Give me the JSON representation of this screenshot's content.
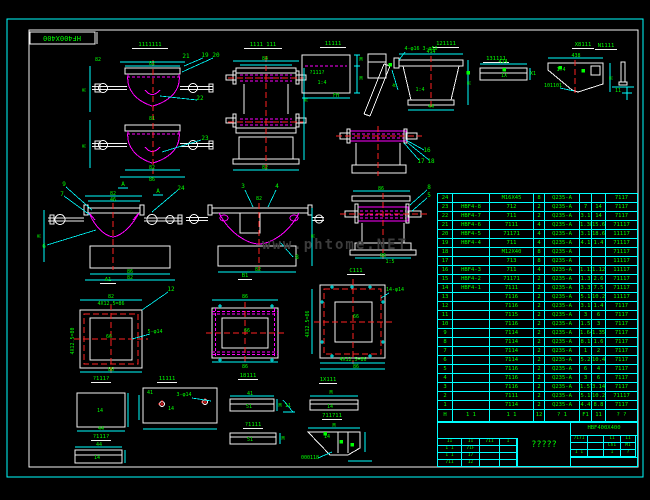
{
  "colors": {
    "background": "#000000",
    "frame_outer": "#00ffff",
    "frame_inner": "#f2f2f2",
    "part_outline": "#ff00ff",
    "dimension": "#00ffff",
    "text": "#00ff00",
    "centerline": "#ff2222",
    "watermark": "#3c3c3c"
  },
  "frame_label": "HF400X400",
  "watermark": "www.phtome.NET",
  "titles": [
    {
      "x": 150,
      "y": 46,
      "w": 36,
      "t": "1111111"
    },
    {
      "x": 263,
      "y": 46,
      "w": 38,
      "t": "1111 111"
    },
    {
      "x": 333,
      "y": 45,
      "w": 26,
      "t": "11111"
    },
    {
      "x": 446,
      "y": 45,
      "w": 26,
      "t": "121111"
    },
    {
      "x": 496,
      "y": 60,
      "w": 26,
      "t": "131111"
    },
    {
      "x": 583,
      "y": 46,
      "w": 22,
      "t": "X8111"
    },
    {
      "x": 606,
      "y": 47,
      "w": 22,
      "t": "N1111"
    },
    {
      "x": 108,
      "y": 281,
      "w": 16,
      "t": "A1"
    },
    {
      "x": 245,
      "y": 277,
      "w": 14,
      "t": "B1"
    },
    {
      "x": 356,
      "y": 272,
      "w": 18,
      "t": "C111"
    },
    {
      "x": 101,
      "y": 380,
      "w": 20,
      "t": "?111?"
    },
    {
      "x": 167,
      "y": 380,
      "w": 20,
      "t": "11111"
    },
    {
      "x": 248,
      "y": 377,
      "w": 20,
      "t": "18111"
    },
    {
      "x": 328,
      "y": 381,
      "w": 18,
      "t": "1X111"
    },
    {
      "x": 101,
      "y": 438,
      "w": 20,
      "t": "?111?"
    },
    {
      "x": 253,
      "y": 426,
      "w": 20,
      "t": "?1111"
    },
    {
      "x": 332,
      "y": 417,
      "w": 20,
      "t": "711711"
    }
  ],
  "dims": [
    {
      "x": 152,
      "y": 65,
      "t": "82"
    },
    {
      "x": 98,
      "y": 61,
      "t": "82"
    },
    {
      "x": 86,
      "y": 90,
      "t": "M",
      "r": -90
    },
    {
      "x": 86,
      "y": 146,
      "t": "M",
      "r": -90
    },
    {
      "x": 152,
      "y": 120,
      "t": "81"
    },
    {
      "x": 152,
      "y": 169,
      "t": "82"
    },
    {
      "x": 152,
      "y": 181,
      "t": "86"
    },
    {
      "x": 265,
      "y": 60,
      "t": "84"
    },
    {
      "x": 308,
      "y": 100,
      "t": "M",
      "r": -90
    },
    {
      "x": 265,
      "y": 169,
      "t": "82"
    },
    {
      "x": 317,
      "y": 74,
      "t": "?111?"
    },
    {
      "x": 322,
      "y": 84,
      "t": "1:4"
    },
    {
      "x": 336,
      "y": 97,
      "t": "FH"
    },
    {
      "x": 361,
      "y": 61,
      "t": "M"
    },
    {
      "x": 361,
      "y": 80,
      "t": "M"
    },
    {
      "x": 396,
      "y": 86,
      "t": "M",
      "r": -70
    },
    {
      "x": 421,
      "y": 50,
      "t": "4-φ16 3-φ50"
    },
    {
      "x": 420,
      "y": 91,
      "t": "1:4"
    },
    {
      "x": 471,
      "y": 83,
      "t": "M",
      "r": -90
    },
    {
      "x": 431,
      "y": 108,
      "t": "44"
    },
    {
      "x": 431,
      "y": 53,
      "t": "414"
    },
    {
      "x": 503,
      "y": 63,
      "t": "414"
    },
    {
      "x": 533,
      "y": 75,
      "t": "X1"
    },
    {
      "x": 504,
      "y": 77,
      "t": "1X"
    },
    {
      "x": 576,
      "y": 57,
      "t": "438"
    },
    {
      "x": 561,
      "y": 71,
      "t": "1:4"
    },
    {
      "x": 613,
      "y": 78,
      "t": "M",
      "r": -90
    },
    {
      "x": 553,
      "y": 87,
      "t": "101101"
    },
    {
      "x": 618,
      "y": 92,
      "t": "11"
    },
    {
      "x": 113,
      "y": 195,
      "t": "82"
    },
    {
      "x": 113,
      "y": 201,
      "t": "46"
    },
    {
      "x": 130,
      "y": 273,
      "t": "86"
    },
    {
      "x": 130,
      "y": 279,
      "t": "82"
    },
    {
      "x": 41,
      "y": 236,
      "t": "M",
      "r": -90
    },
    {
      "x": 259,
      "y": 200,
      "t": "82"
    },
    {
      "x": 258,
      "y": 271,
      "t": "82"
    },
    {
      "x": 315,
      "y": 236,
      "t": "M",
      "r": -90
    },
    {
      "x": 381,
      "y": 190,
      "t": "86"
    },
    {
      "x": 383,
      "y": 257,
      "t": "86"
    },
    {
      "x": 390,
      "y": 263,
      "t": "1:5"
    },
    {
      "x": 111,
      "y": 298,
      "t": "82"
    },
    {
      "x": 111,
      "y": 305,
      "t": "4X12.5=86"
    },
    {
      "x": 74,
      "y": 341,
      "t": "4X12.5=80",
      "r": -90
    },
    {
      "x": 155,
      "y": 333,
      "t": "5-φ14"
    },
    {
      "x": 111,
      "y": 371,
      "t": "86"
    },
    {
      "x": 109,
      "y": 338,
      "t": "66"
    },
    {
      "x": 245,
      "y": 298,
      "t": "86"
    },
    {
      "x": 247,
      "y": 332,
      "t": "66"
    },
    {
      "x": 245,
      "y": 368,
      "t": "86"
    },
    {
      "x": 395,
      "y": 291,
      "t": "14-φ14"
    },
    {
      "x": 309,
      "y": 324,
      "t": "4X12.5=86",
      "r": -90
    },
    {
      "x": 356,
      "y": 318,
      "t": "66"
    },
    {
      "x": 353,
      "y": 361,
      "t": "4X12.5=86"
    },
    {
      "x": 356,
      "y": 368,
      "t": "86"
    },
    {
      "x": 100,
      "y": 412,
      "t": "14"
    },
    {
      "x": 101,
      "y": 430,
      "t": "44"
    },
    {
      "x": 150,
      "y": 394,
      "t": "41"
    },
    {
      "x": 184,
      "y": 396,
      "t": "3-φ14"
    },
    {
      "x": 171,
      "y": 410,
      "t": "14"
    },
    {
      "x": 99,
      "y": 446,
      "t": "44"
    },
    {
      "x": 97,
      "y": 459,
      "t": "14"
    },
    {
      "x": 250,
      "y": 395,
      "t": "41"
    },
    {
      "x": 249,
      "y": 408,
      "t": "51"
    },
    {
      "x": 280,
      "y": 407,
      "t": "M"
    },
    {
      "x": 250,
      "y": 441,
      "t": "51"
    },
    {
      "x": 283,
      "y": 440,
      "t": "M"
    },
    {
      "x": 331,
      "y": 394,
      "t": "M"
    },
    {
      "x": 330,
      "y": 408,
      "t": "14"
    },
    {
      "x": 288,
      "y": 407,
      "t": "11"
    },
    {
      "x": 334,
      "y": 427,
      "t": "M"
    },
    {
      "x": 327,
      "y": 438,
      "t": "14"
    },
    {
      "x": 310,
      "y": 459,
      "t": "000118"
    }
  ],
  "callouts": [
    {
      "x": 186,
      "y": 58,
      "t": "21"
    },
    {
      "x": 205,
      "y": 57,
      "t": "19"
    },
    {
      "x": 216,
      "y": 57,
      "t": "20"
    },
    {
      "x": 200,
      "y": 100,
      "t": "22"
    },
    {
      "x": 205,
      "y": 140,
      "t": "23"
    },
    {
      "x": 64,
      "y": 186,
      "t": "9"
    },
    {
      "x": 62,
      "y": 196,
      "t": "7"
    },
    {
      "x": 44,
      "y": 248,
      "t": "6"
    },
    {
      "x": 181,
      "y": 190,
      "t": "24"
    },
    {
      "x": 123,
      "y": 186,
      "t": "A"
    },
    {
      "x": 158,
      "y": 193,
      "t": "A"
    },
    {
      "x": 243,
      "y": 188,
      "t": "3"
    },
    {
      "x": 277,
      "y": 188,
      "t": "4"
    },
    {
      "x": 297,
      "y": 259,
      "t": "8"
    },
    {
      "x": 427,
      "y": 152,
      "t": "16"
    },
    {
      "x": 421,
      "y": 163,
      "t": "17"
    },
    {
      "x": 431,
      "y": 163,
      "t": "18"
    },
    {
      "x": 429,
      "y": 189,
      "t": "8"
    },
    {
      "x": 429,
      "y": 197,
      "t": "5"
    },
    {
      "x": 171,
      "y": 291,
      "t": "12"
    }
  ],
  "marks": [
    {
      "x": 390,
      "y": 66
    },
    {
      "x": 468,
      "y": 74
    },
    {
      "x": 583,
      "y": 72
    },
    {
      "x": 504,
      "y": 71
    },
    {
      "x": 560,
      "y": 69
    },
    {
      "x": 341,
      "y": 443
    },
    {
      "x": 352,
      "y": 446
    },
    {
      "x": 325,
      "y": 435
    }
  ],
  "bom": {
    "rows": [
      [
        "24",
        "",
        "M16X45",
        "8",
        "Q235-A",
        "",
        "",
        "7117"
      ],
      [
        "23",
        "HBF4-8",
        "712",
        "2",
        "Q235-A",
        "7",
        "14",
        "7117"
      ],
      [
        "22",
        "HBF4-7",
        "711",
        "2",
        "Q235-A",
        "3.1",
        "14",
        "7117"
      ],
      [
        "21",
        "HBF4-6",
        "7111",
        "4",
        "Q235-A",
        "1.38",
        "15.6",
        "71117"
      ],
      [
        "20",
        "HBF4-5",
        "71171",
        "4",
        "Q235-A",
        "3.1",
        "18.6",
        "11117"
      ],
      [
        "19",
        "HBF4-4",
        "711",
        "4",
        "Q235-A",
        "4.1",
        "1.4",
        "71117"
      ],
      [
        "18",
        "",
        "M12X40",
        "8",
        "Q235-A",
        "",
        "",
        "71117"
      ],
      [
        "17",
        "",
        "713",
        "8",
        "Q235-A",
        "",
        "",
        "11117"
      ],
      [
        "16",
        "HBF4-3",
        "711",
        "4",
        "Q235-A",
        "1.13",
        "1.12",
        "11117"
      ],
      [
        "15",
        "HBF4-2",
        "71171",
        "2",
        "Q235-A",
        "1.3",
        "2.6",
        "71117"
      ],
      [
        "14",
        "HBF4-1",
        "7111",
        "2",
        "Q235-A",
        "3.3",
        "7.5",
        "71117"
      ],
      [
        "13",
        "",
        "7116",
        "2",
        "Q235-A",
        "5.1",
        "10.2",
        "11117"
      ],
      [
        "12",
        "",
        "7116",
        "2",
        "Q235-A",
        "3.1",
        "1.4",
        "7117"
      ],
      [
        "11",
        "",
        "7115",
        "2",
        "Q235-A",
        "3",
        "6",
        "7117"
      ],
      [
        "10",
        "",
        "7116",
        "2",
        "Q235-A",
        "1.5",
        "3",
        "7117"
      ],
      [
        "9",
        "",
        "7114",
        "2",
        "Q235-A",
        "1.64",
        "1.35",
        "7117"
      ],
      [
        "8",
        "",
        "7114",
        "2",
        "Q235-A",
        "8.1",
        "1.6",
        "7117"
      ],
      [
        "7",
        "",
        "7114",
        "2",
        "Q235-A",
        "1",
        "2",
        "7117"
      ],
      [
        "6",
        "",
        "7114",
        "2",
        "Q235-A",
        "5.2",
        "10.4",
        "7117"
      ],
      [
        "5",
        "",
        "7116",
        "2",
        "Q235-A",
        "6",
        "4",
        "7117"
      ],
      [
        "4",
        "",
        "7116",
        "2",
        "Q235-A",
        "3",
        "6",
        "7117"
      ],
      [
        "3",
        "",
        "7116",
        "2",
        "Q235-A",
        "1.57",
        "3.14",
        "7117"
      ],
      [
        "2",
        "",
        "7111",
        "2",
        "Q235-A",
        "5.1",
        "10.2",
        "71117"
      ],
      [
        "1",
        "",
        "7114",
        "2",
        "Q235-A",
        "4.4",
        "8.8",
        "7117"
      ]
    ],
    "footer": [
      "H",
      "1 1",
      "1 1",
      "12",
      "? 1",
      "F1",
      "11",
      "? ?"
    ]
  },
  "title_block": {
    "code": "HBF400X400",
    "title": "?????",
    "sign_rows": [
      [
        "11",
        "11",
        "711",
        "1"
      ],
      [
        "1 1",
        "71F",
        "",
        ""
      ],
      [
        "1 1",
        "17",
        "",
        ""
      ],
      [
        "711",
        "12",
        "",
        ""
      ]
    ],
    "right_rows": [
      [
        "7171",
        "",
        "11",
        "11"
      ],
      [
        "",
        "",
        "Ch1",
        "M1"
      ],
      [
        "1 1",
        "",
        "1",
        "?"
      ]
    ]
  }
}
